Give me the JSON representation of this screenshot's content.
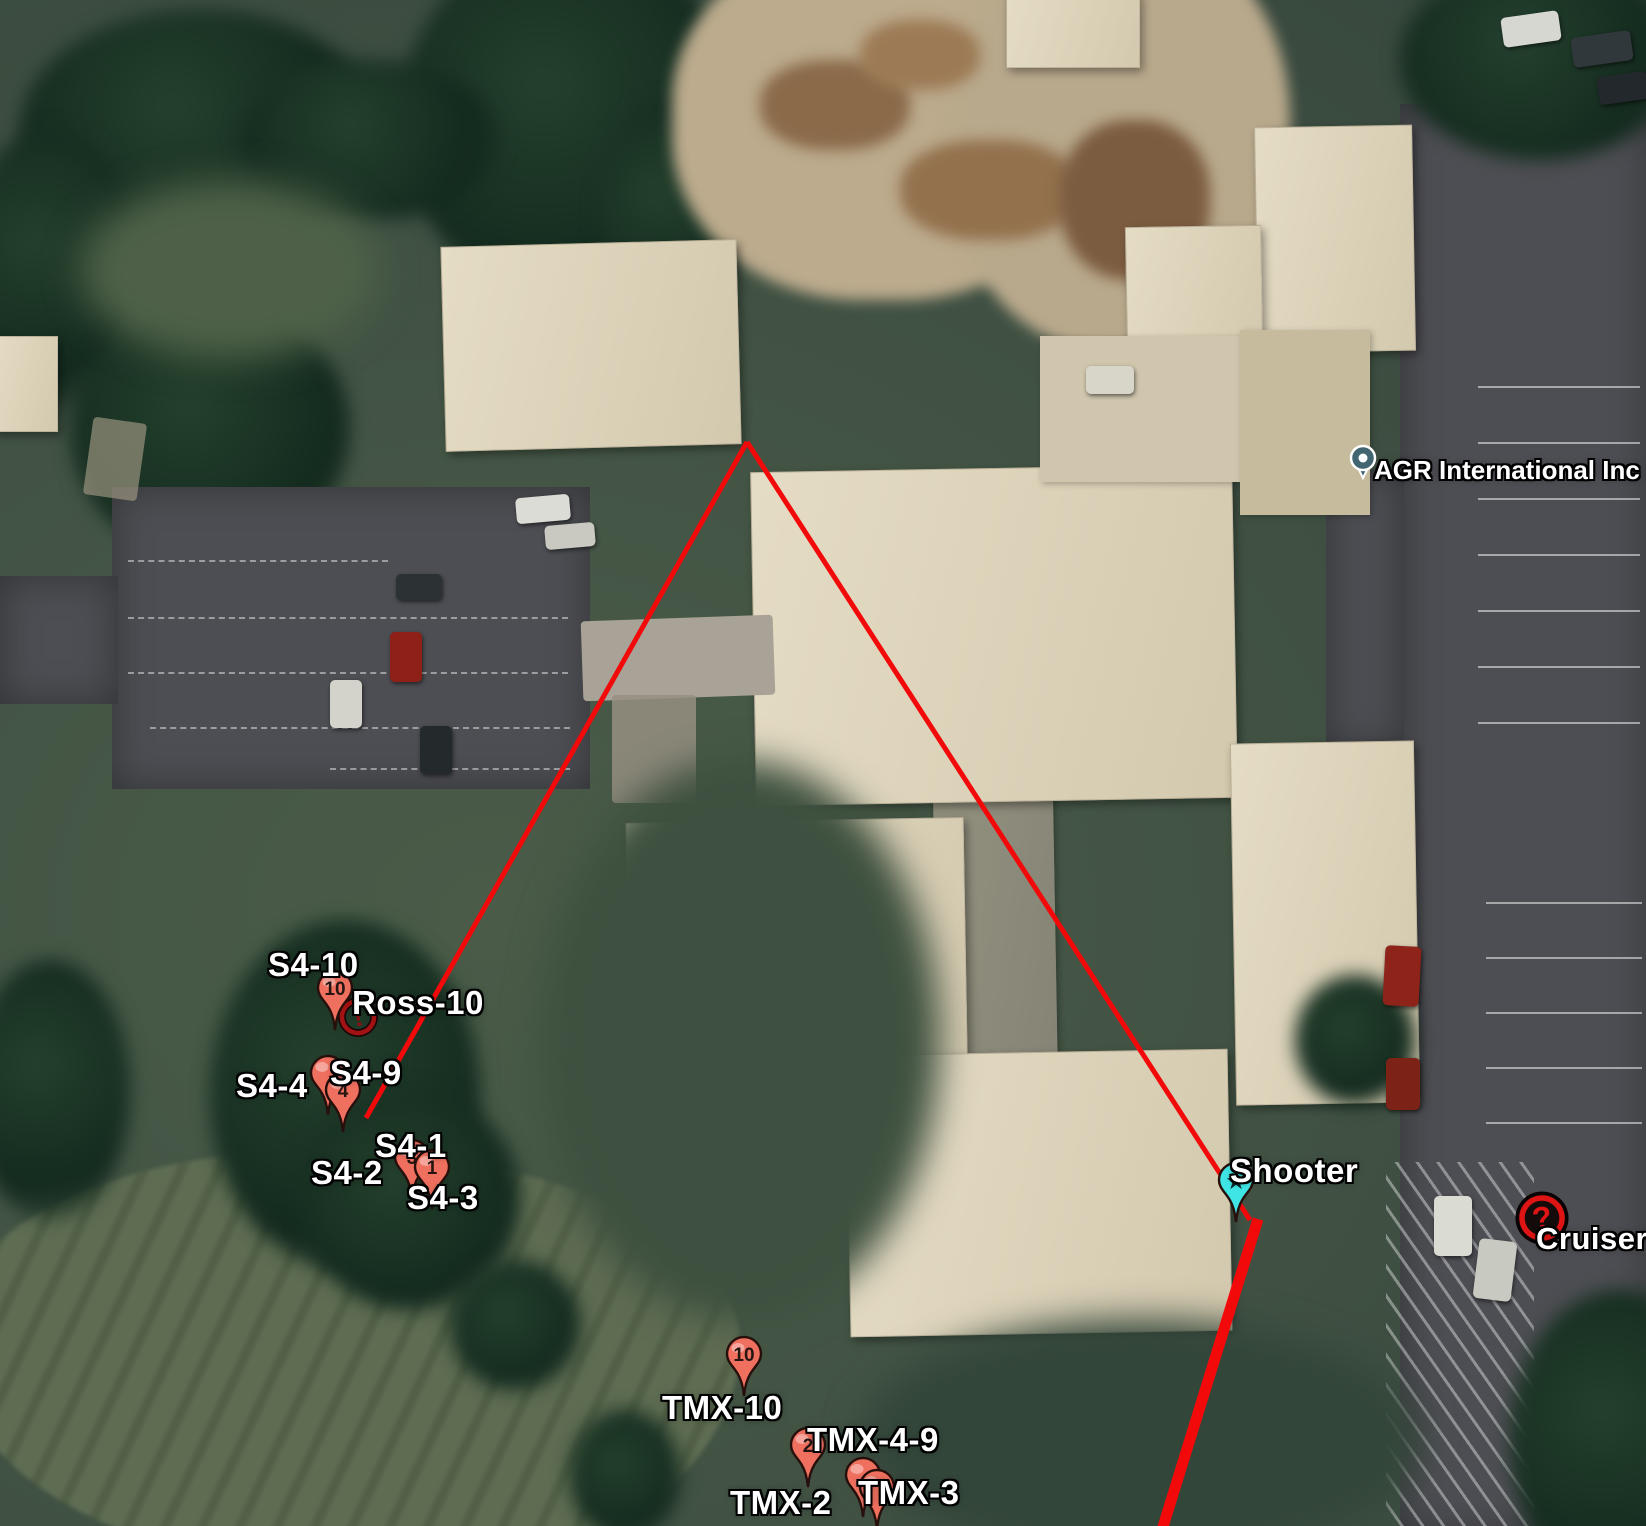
{
  "markers": {
    "s4_10": "S4-10",
    "ross_10": "Ross-10",
    "s4_4": "S4-4",
    "s4_9": "S4-9",
    "s4_1": "S4-1",
    "s4_2": "S4-2",
    "s4_3": "S4-3",
    "tmx_10": "TMX-10",
    "tmx_4_9": "TMX-4-9",
    "tmx_2": "TMX-2",
    "tmx_3": "TMX-3",
    "shooter": "Shooter",
    "cruiser": "Cruiser",
    "agr": "AGR International Inc"
  },
  "pins": {
    "s4_pin_10": "10",
    "s4_pin_4": "4",
    "s4_pin_3": "3",
    "s4_pin_1": "1",
    "tmx_pin_10": "10",
    "tmx_pin_2": "2",
    "ross_glyph": "!",
    "cruiser_glyph": "?",
    "shooter_glyph": "★"
  },
  "colors": {
    "path_red": "#f20a0a",
    "pin_fill": "#f0705f",
    "shooter_pin": "#3fe4e4",
    "cruiser_red": "#df1414",
    "ross_red": "#a31212",
    "agr_pin": "#416672"
  }
}
